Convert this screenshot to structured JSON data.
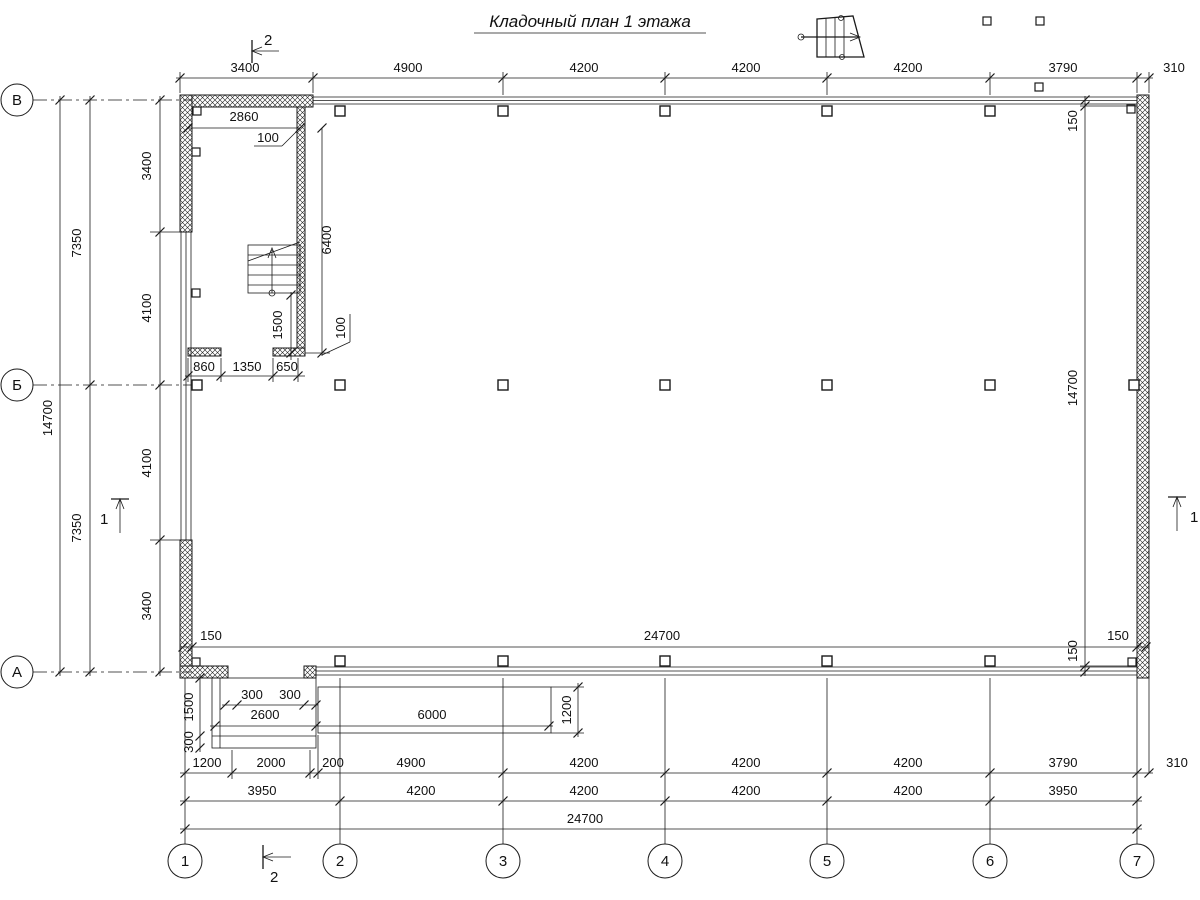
{
  "title": "Кладочный план 1 этажа",
  "row_axes": {
    "top": "В",
    "middle": "Б",
    "bottom": "А"
  },
  "col_axes": [
    "1",
    "2",
    "3",
    "4",
    "5",
    "6",
    "7"
  ],
  "markers": {
    "section2_top": "2",
    "section2_bottom": "2",
    "section1_left": "1",
    "section1_right": "1"
  },
  "dims": {
    "top": [
      "3400",
      "4900",
      "4200",
      "4200",
      "4200",
      "3790",
      "310"
    ],
    "left_total": "14700",
    "left_halves": [
      "7350",
      "7350"
    ],
    "left_inner": [
      "3400",
      "4100",
      "4100",
      "3400"
    ],
    "right": [
      "150",
      "14700",
      "150"
    ],
    "inner_width": [
      "150",
      "24700",
      "150"
    ],
    "stair_width": "2860",
    "stair_wall": "100",
    "stair_depth": "6400",
    "stair_landing": "1500",
    "stair_stub": "100",
    "stair_bottom": [
      "860",
      "1350",
      "650"
    ],
    "porch_side": [
      "1500",
      "300"
    ],
    "porch_offsets": [
      "300",
      "300"
    ],
    "porch_width": "2600",
    "ramp_length": "6000",
    "ramp_width": "1200",
    "bottom_row1": [
      "1200",
      "2000",
      "200",
      "4900",
      "4200",
      "4200",
      "4200",
      "3790",
      "310"
    ],
    "bottom_row2": [
      "3950",
      "4200",
      "4200",
      "4200",
      "4200",
      "3950"
    ],
    "bottom_total": "24700"
  }
}
